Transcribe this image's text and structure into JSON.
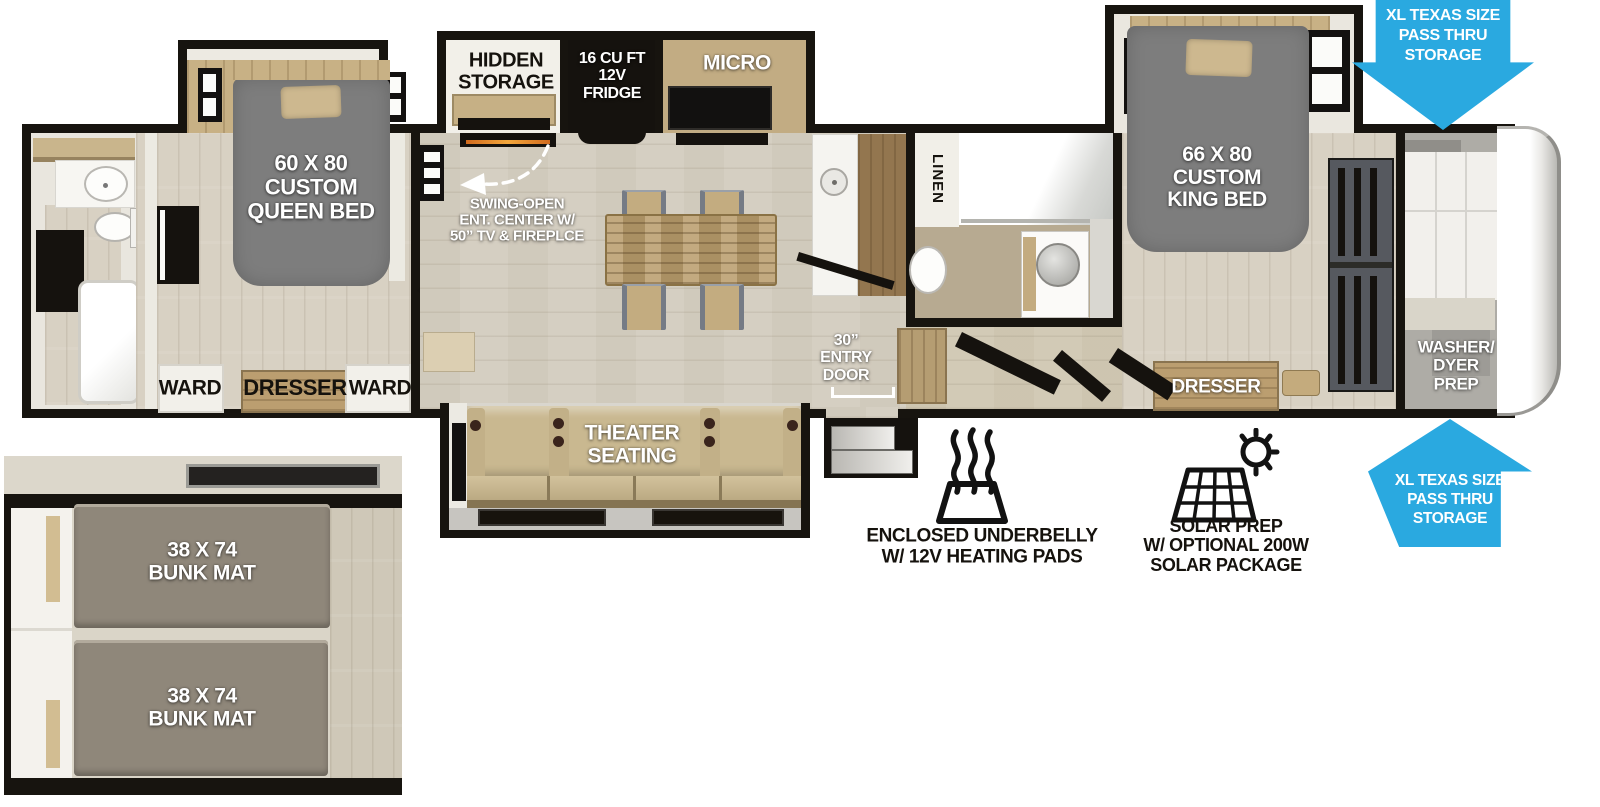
{
  "front_bedroom": {
    "bed": "60 X 80\nCUSTOM\nQUEEN BED",
    "ward_left": "WARD",
    "dresser": "DRESSER",
    "ward_right": "WARD"
  },
  "kitchen": {
    "hidden_storage": "HIDDEN\nSTORAGE",
    "fridge": "16 CU FT\n12V\nFRIDGE",
    "micro": "MICRO",
    "ent_center": "SWING-OPEN\nENT. CENTER W/\n50” TV & FIREPLCE"
  },
  "living": {
    "theater": "THEATER\nSEATING",
    "entry_door": "30”\nENTRY\nDOOR"
  },
  "bathroom": {
    "linen": "LINEN"
  },
  "rear_bedroom": {
    "bed": "66 X 80\nCUSTOM\nKING BED",
    "dresser": "DRESSER",
    "washer_dryer": "WASHER/\nDYER\nPREP"
  },
  "bunk_room": {
    "bunk_top": "38 X 74\nBUNK MAT",
    "bunk_bottom": "38 X 74\nBUNK MAT"
  },
  "features": {
    "underbelly": "ENCLOSED UNDERBELLY\nW/ 12V HEATING PADS",
    "solar": "SOLAR PREP\nW/ OPTIONAL 200W\nSOLAR PACKAGE",
    "pass_thru_top": "XL TEXAS SIZE\nPASS THRU\nSTORAGE",
    "pass_thru_bottom": "XL TEXAS SIZE\nPASS THRU\nSTORAGE"
  },
  "colors": {
    "arrow_blue": "#2aa9e0",
    "wall_black": "#17140f"
  }
}
